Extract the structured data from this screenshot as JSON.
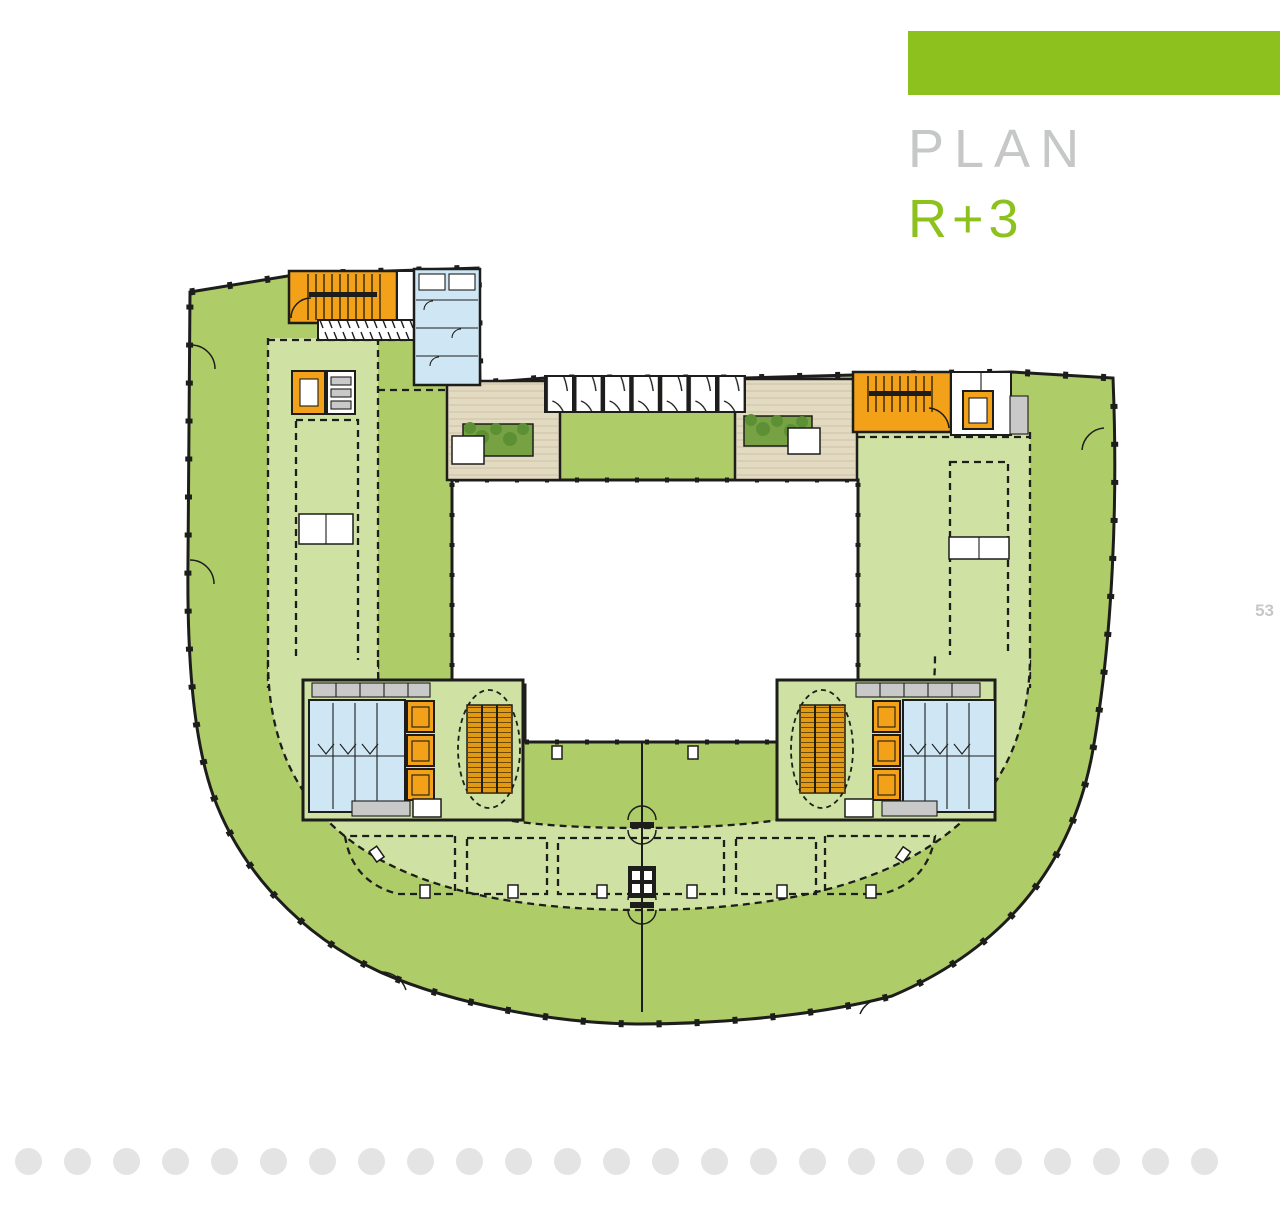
{
  "page": {
    "title": "PLAN",
    "floor_label": "R+3",
    "page_number": "53"
  },
  "footer": {
    "dots_count": 25
  },
  "colors": {
    "accent": "#8cc11e",
    "titlegray": "#c6c7c7",
    "green": "#aecd68",
    "lightgreen": "#cfe2a3",
    "stair": "#f3a118",
    "escalator": "#e09a15",
    "blue": "#cfe7f4",
    "beige": "#e3dac2",
    "plank": "#cfc3a5",
    "planter": "#76a244",
    "leaf": "#5d8f35",
    "wall": "#1d1d1b",
    "gray": "#c9c9c9",
    "dot": "#e4e4e5"
  }
}
